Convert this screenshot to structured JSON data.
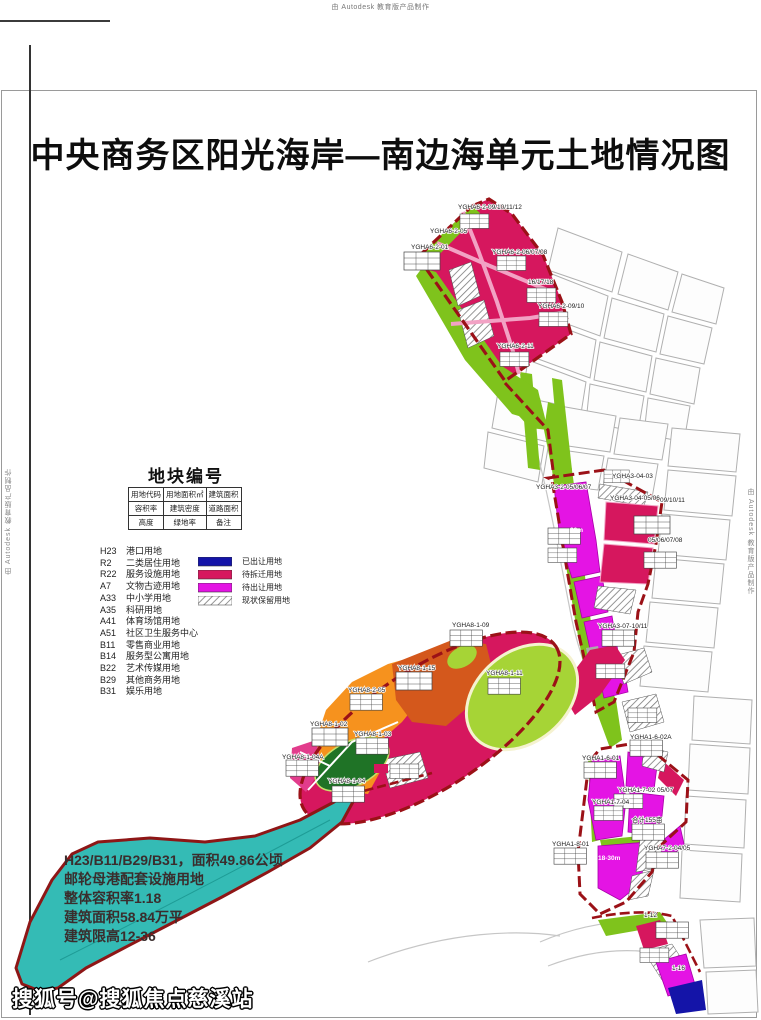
{
  "page": {
    "top_watermark": "由 Autodesk 教育版产品制作",
    "side_watermark": "由 Autodesk 教育版产品制作",
    "bottom_watermark": "搜狐号@搜狐焦点慈溪站"
  },
  "title": "中央商务区阳光海岸—南边海单元土地情况图",
  "legend": {
    "block_title": "地块编号",
    "key_table": {
      "rows": [
        [
          "用地代码",
          "用地面积㎡",
          "建筑面积"
        ],
        [
          "容积率",
          "建筑密度",
          "道路面积"
        ],
        [
          "高度",
          "绿地率",
          "备注"
        ]
      ]
    },
    "land_use_codes": [
      {
        "code": "H23",
        "name": "港口用地"
      },
      {
        "code": "R2",
        "name": "二类居住用地"
      },
      {
        "code": "R22",
        "name": "服务设施用地"
      },
      {
        "code": "A7",
        "name": "文物古迹用地"
      },
      {
        "code": "A33",
        "name": "中小学用地"
      },
      {
        "code": "A35",
        "name": "科研用地"
      },
      {
        "code": "A41",
        "name": "体育场馆用地"
      },
      {
        "code": "A51",
        "name": "社区卫生服务中心"
      },
      {
        "code": "B11",
        "name": "零售商业用地"
      },
      {
        "code": "B14",
        "name": "服务型公寓用地"
      },
      {
        "code": "B22",
        "name": "艺术传媒用地"
      },
      {
        "code": "B29",
        "name": "其他商务用地"
      },
      {
        "code": "B31",
        "name": "娱乐用地"
      }
    ],
    "status_legend": [
      {
        "label": "已出让用地",
        "color": "#1414A8",
        "hatched": false
      },
      {
        "label": "待拆迁用地",
        "color": "#D6175E",
        "hatched": false
      },
      {
        "label": "待出让用地",
        "color": "#E414E4",
        "hatched": false
      },
      {
        "label": "现状保留用地",
        "color": "#FFFFFF",
        "hatched": true
      }
    ]
  },
  "harbor_note": {
    "lines": [
      "H23/B11/B29/B31，面积49.86公顷",
      "邮轮母港配套设施用地",
      "整体容积率1.18",
      "建筑面积58.84万平",
      "建筑限高12-36"
    ]
  },
  "map": {
    "labels": [
      {
        "text": "YGHA6-2-09/10/11/12"
      },
      {
        "text": "YGHA6-2-05"
      },
      {
        "text": "YGHA6-2-01"
      },
      {
        "text": "YGHA6-2-06/07/08"
      },
      {
        "text": "16/17/18"
      },
      {
        "text": "YGHA6-2-09/10"
      },
      {
        "text": "YGHA6-2-11"
      },
      {
        "text": "YGHA3-2-05/06/07"
      },
      {
        "text": "YGHA3-04-03"
      },
      {
        "text": "YGHA3-04-05/06"
      },
      {
        "text": "09/10/11"
      },
      {
        "text": "05/06/07/08"
      },
      {
        "text": "90m"
      },
      {
        "text": "YGHA3-07-10/11"
      },
      {
        "text": "YGHA8-1-09"
      },
      {
        "text": "YGHA8-1-15"
      },
      {
        "text": "YGHA8-2-05"
      },
      {
        "text": "YGHA8-1-02"
      },
      {
        "text": "YGHA8-1-03"
      },
      {
        "text": "YGHA8-1-04A"
      },
      {
        "text": "YGHA8-1-04"
      },
      {
        "text": "YGHA8-1-11"
      },
      {
        "text": "YGHA1-6-02A"
      },
      {
        "text": "YGHA1-6-01"
      },
      {
        "text": "YGHA1-7-02 05/07"
      },
      {
        "text": "YGHA1-7-04"
      },
      {
        "text": "合计155亩"
      },
      {
        "text": "YGHA1-8-01"
      },
      {
        "text": "YGHA7-2-04/05"
      },
      {
        "text": "18-30m"
      },
      {
        "text": "1-12"
      },
      {
        "text": "1-16"
      }
    ]
  },
  "colors": {
    "sold_blue": "#1414A8",
    "demolition_crimson": "#D6175E",
    "transfer_magenta": "#E414E4",
    "green_belt": "#7FC31C",
    "park_green": "#A6D436",
    "dark_green": "#1F7326",
    "orange": "#F6921E",
    "dark_orange": "#D4581C",
    "harbor_cyan": "#34BBB5",
    "boundary_red": "#9B1117",
    "road_pink": "#F2A2C4"
  }
}
